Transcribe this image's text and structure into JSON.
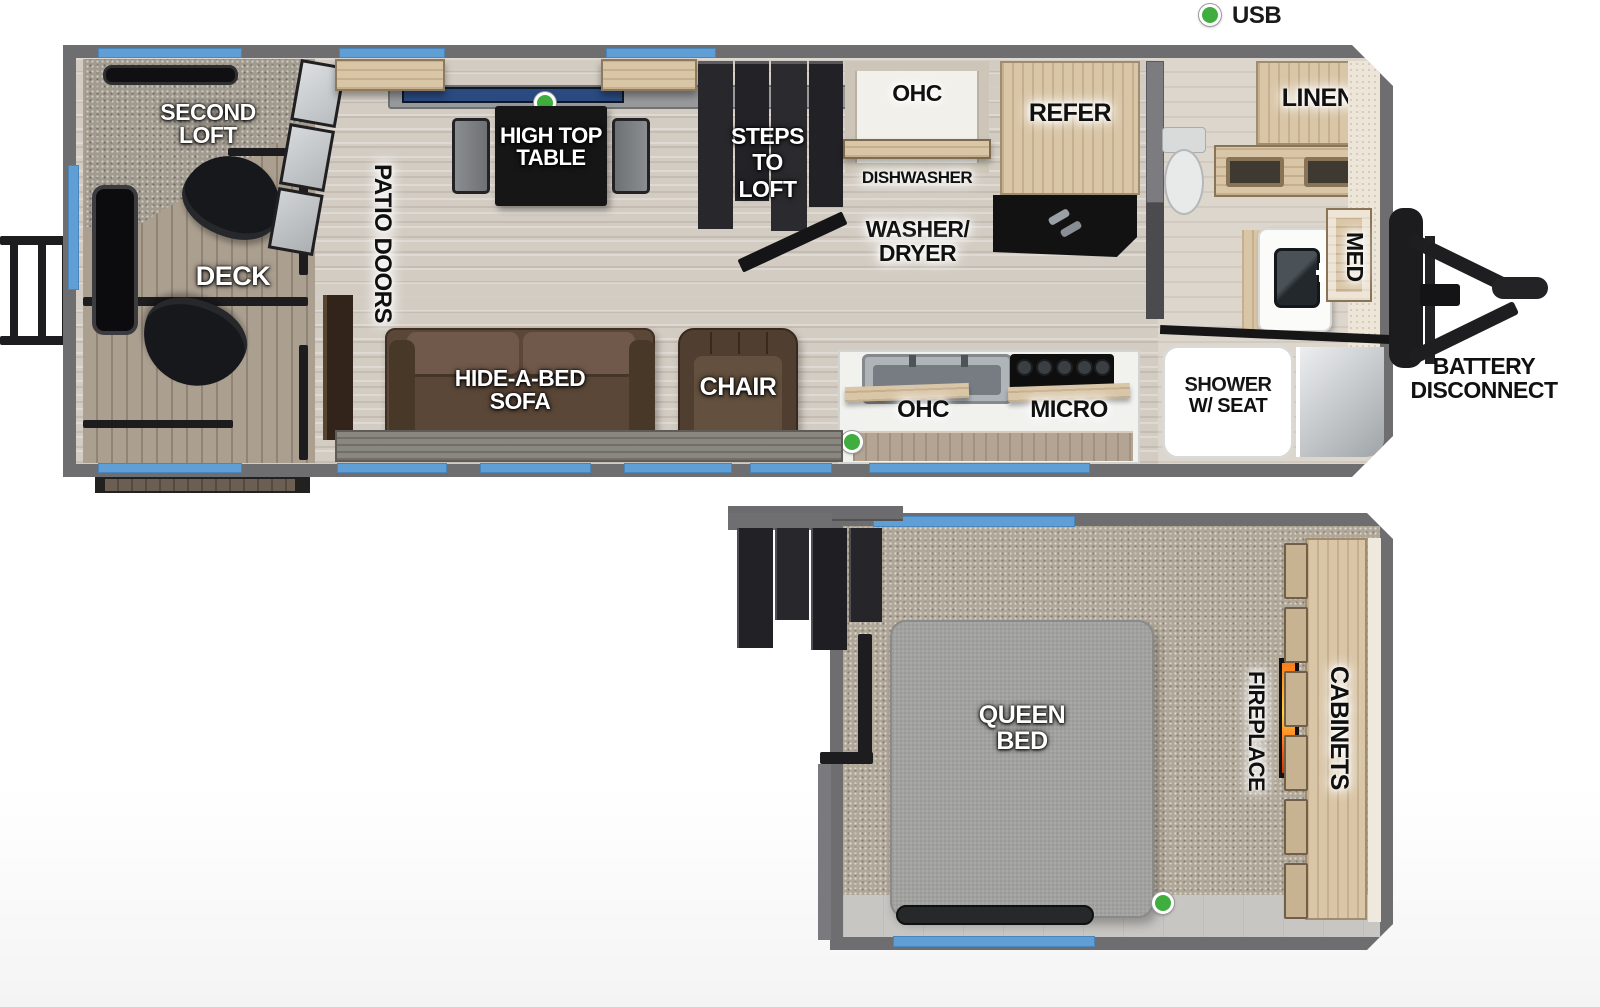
{
  "legend": {
    "usb": "USB"
  },
  "labels": {
    "second_loft": [
      "SECOND",
      "LOFT"
    ],
    "deck": "DECK",
    "patio_doors": "PATIO DOORS",
    "high_top_table": [
      "HIGH TOP",
      "TABLE"
    ],
    "steps_to_loft": [
      "STEPS",
      "TO",
      "LOFT"
    ],
    "ohc_kitchen_top": "OHC",
    "dishwasher": "DISHWASHER",
    "washer_dryer": [
      "WASHER/",
      "DRYER"
    ],
    "refer": "REFER",
    "linen": "LINEN",
    "med": "MED",
    "hide_a_bed_sofa": [
      "HIDE-A-BED",
      "SOFA"
    ],
    "chair": "CHAIR",
    "ohc_kitchen_bottom": "OHC",
    "micro": "MICRO",
    "shower": [
      "SHOWER",
      "W/ SEAT"
    ],
    "battery_disconnect": [
      "BATTERY",
      "DISCONNECT"
    ],
    "queen_bed": [
      "QUEEN",
      "BED"
    ],
    "fireplace": "FIREPLACE",
    "cabinets": "CABINETS"
  },
  "colors": {
    "wall": "#6e6e70",
    "window_accent": "#5f9fd6",
    "usb_dot": "#3fae3f",
    "table_window_navy": "#2a4a80",
    "cabinet_wood": "#d9c6a7",
    "carpet": "#a19a8e",
    "sofa_brown": "#5a4738",
    "flame_orange": "#ff7a1a"
  }
}
